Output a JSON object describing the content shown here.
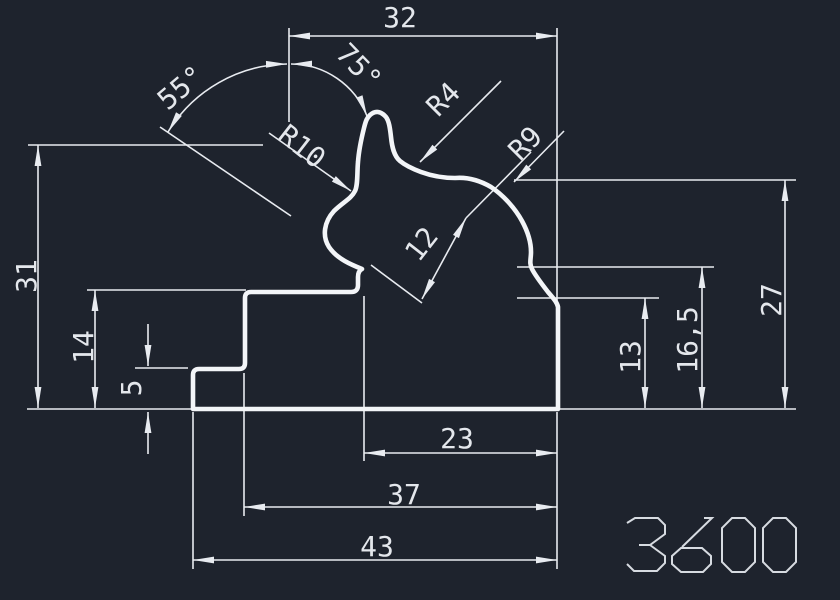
{
  "canvas": {
    "background": "#1e232d"
  },
  "colors": {
    "line": "#e8ebf0",
    "profile": "#f3f5f8",
    "text": "#e4e7ec",
    "glyph": "#d7dbe1"
  },
  "dimensions": {
    "top_width": "32",
    "overall_height": "31",
    "step_height": "14",
    "foot_height": "5",
    "right_height": "27",
    "right_mid_height": "16,5",
    "right_inner_height": "13",
    "bottom_inner_width": "23",
    "bottom_mid_width": "37",
    "bottom_overall_width": "43",
    "band_width": "12"
  },
  "angles": {
    "left": "55°",
    "right": "75°"
  },
  "radii": {
    "upper_left": "R10",
    "upper_middle": "R4",
    "upper_right": "R9"
  },
  "title_block": {
    "drawing_number": "3600"
  }
}
